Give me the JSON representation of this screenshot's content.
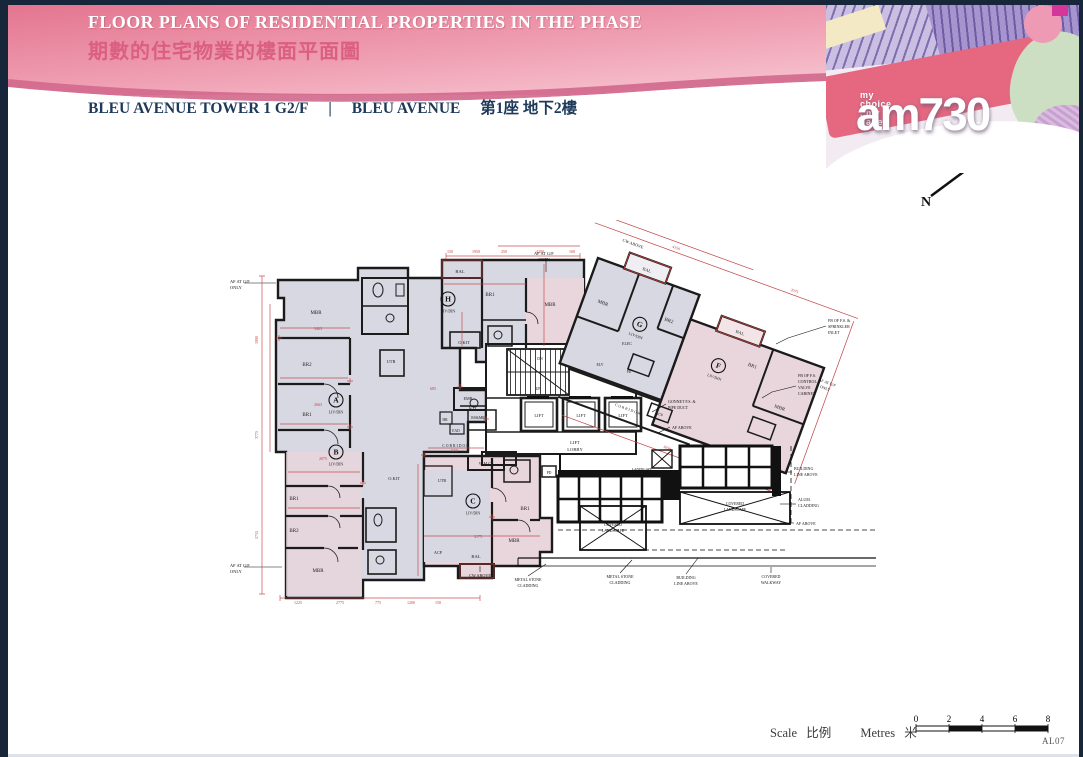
{
  "banner": {
    "title_en": "FLOOR PLANS OF RESIDENTIAL PROPERTIES IN THE PHASE",
    "title_zh": "期數的住宅物業的樓面平面圖"
  },
  "masthead": {
    "tagline": "my choice . my paper",
    "brand": "am730"
  },
  "subtitle": {
    "tower": "BLEU AVENUE TOWER 1  G2/F",
    "divider": "|",
    "name_en": "BLEU AVENUE",
    "name_zh": "第1座 地下2樓"
  },
  "compass": {
    "label": "N"
  },
  "scale_bar": {
    "label_en": "Scale",
    "label_zh": "比例",
    "unit_en": "Metres",
    "unit_zh": "米",
    "ticks": [
      "0",
      "2",
      "4",
      "6",
      "8"
    ]
  },
  "footer": {
    "page_code": "AL07"
  },
  "plan": {
    "colors": {
      "wall": "#1b1b1b",
      "dim": "#c24040",
      "text": "#222222",
      "annot": "#111111",
      "fill_gray": "#d8d8e2",
      "fill_pink": "#e9d6dc"
    },
    "unit_badges": [
      {
        "letter": "A",
        "sub": "LIV/DIN",
        "x": 108,
        "y": 180
      },
      {
        "letter": "B",
        "sub": "LIV/DIN",
        "x": 108,
        "y": 232
      },
      {
        "letter": "C",
        "sub": "LIV/DIN",
        "x": 245,
        "y": 281
      },
      {
        "letter": "H",
        "sub": "LIV/DIN",
        "x": 220,
        "y": 79
      }
    ],
    "rot_unit_badges": [
      {
        "letter": "G",
        "sub": "LIV/DIN",
        "x": 62,
        "y": 48
      },
      {
        "letter": "F",
        "sub": "LIV/DIN",
        "x": 150,
        "y": 60
      }
    ],
    "labels": [
      {
        "t": "MBR",
        "x": 88,
        "y": 94
      },
      {
        "t": "BR2",
        "x": 79,
        "y": 146
      },
      {
        "t": "BR1",
        "x": 79,
        "y": 196
      },
      {
        "t": "UTR",
        "x": 163,
        "y": 143,
        "s": 4.4
      },
      {
        "t": "KIT",
        "x": 245,
        "y": 190,
        "s": 4.8
      },
      {
        "t": "BR1",
        "x": 66,
        "y": 280
      },
      {
        "t": "BR2",
        "x": 66,
        "y": 312
      },
      {
        "t": "MBR",
        "x": 90,
        "y": 352
      },
      {
        "t": "W.M.C",
        "x": 257,
        "y": 245,
        "s": 4.2
      },
      {
        "t": "UTR",
        "x": 214,
        "y": 262,
        "s": 4.2
      },
      {
        "t": "O.KIT",
        "x": 166,
        "y": 260,
        "s": 4.4
      },
      {
        "t": "BR1",
        "x": 297,
        "y": 290
      },
      {
        "t": "MBR",
        "x": 286,
        "y": 322
      },
      {
        "t": "BAL",
        "x": 248,
        "y": 338,
        "s": 4.6
      },
      {
        "t": "ACP",
        "x": 210,
        "y": 334,
        "s": 4.2
      },
      {
        "t": "CW ABOVE",
        "x": 252,
        "y": 357,
        "s": 4.2,
        "c": "#111111"
      },
      {
        "t": "BAL",
        "x": 232,
        "y": 53,
        "s": 4.6
      },
      {
        "t": "BR1",
        "x": 262,
        "y": 76
      },
      {
        "t": "MBR",
        "x": 322,
        "y": 86
      },
      {
        "t": "O.KIT",
        "x": 236,
        "y": 124,
        "s": 4.4
      },
      {
        "t": "EMR",
        "x": 240,
        "y": 180,
        "s": 4.2
      },
      {
        "t": "HR",
        "x": 217,
        "y": 201,
        "s": 3.8
      },
      {
        "t": "RS&MR",
        "x": 250,
        "y": 199,
        "s": 3.8
      },
      {
        "t": "EAD",
        "x": 228,
        "y": 212,
        "s": 3.6
      },
      {
        "t": "DN",
        "x": 312,
        "y": 140,
        "s": 3.8
      },
      {
        "t": "UP",
        "x": 310,
        "y": 170,
        "s": 3.8
      },
      {
        "t": "LIFT",
        "x": 311,
        "y": 197,
        "s": 4.4
      },
      {
        "t": "LIFT",
        "x": 353,
        "y": 197,
        "s": 4.4
      },
      {
        "t": "LIFT",
        "x": 395,
        "y": 197,
        "s": 4.4
      },
      {
        "t": "LIFT",
        "x": 347,
        "y": 224,
        "s": 4.6
      },
      {
        "t": "LOBBY",
        "x": 347,
        "y": 231,
        "s": 4.6
      },
      {
        "t": "CORRIDOR",
        "x": 228,
        "y": 227,
        "s": 3.8,
        "ls": 1
      },
      {
        "t": "PD",
        "x": 321,
        "y": 254,
        "s": 3.8
      },
      {
        "t": "ELEC",
        "x": 399,
        "y": 125,
        "s": 4
      },
      {
        "t": "ELV",
        "x": 372,
        "y": 146,
        "s": 3.8
      },
      {
        "t": "PD",
        "x": 401,
        "y": 153,
        "s": 3.6
      },
      {
        "t": "AF AT G/F",
        "x": 2,
        "y": 63,
        "a": "start",
        "s": 4.4,
        "c": "#111111"
      },
      {
        "t": "ONLY",
        "x": 2,
        "y": 69,
        "a": "start",
        "s": 4.4,
        "c": "#111111"
      },
      {
        "t": "AF AT G/F",
        "x": 2,
        "y": 347,
        "a": "start",
        "s": 4.4,
        "c": "#111111"
      },
      {
        "t": "ONLY",
        "x": 2,
        "y": 353,
        "a": "start",
        "s": 4.4,
        "c": "#111111"
      },
      {
        "t": "AF AT G/F",
        "x": 306,
        "y": 35,
        "a": "start",
        "s": 4.4,
        "c": "#111111"
      },
      {
        "t": "ONLY",
        "x": 310,
        "y": 41,
        "a": "start",
        "s": 4.4,
        "c": "#111111"
      },
      {
        "t": "GONNET F.S. &",
        "x": 440,
        "y": 183,
        "a": "start",
        "s": 4,
        "c": "#111111"
      },
      {
        "t": "PIPE DUCT",
        "x": 440,
        "y": 189,
        "a": "start",
        "s": 4,
        "c": "#111111"
      },
      {
        "t": "AF ABOVE",
        "x": 444,
        "y": 209,
        "a": "start",
        "s": 4,
        "c": "#111111"
      },
      {
        "t": "FB OF F.S.",
        "x": 570,
        "y": 157,
        "a": "start",
        "s": 4,
        "c": "#111111"
      },
      {
        "t": "CONTROL",
        "x": 570,
        "y": 163,
        "a": "start",
        "s": 4,
        "c": "#111111"
      },
      {
        "t": "VALVE",
        "x": 570,
        "y": 169,
        "a": "start",
        "s": 4,
        "c": "#111111"
      },
      {
        "t": "CABINET",
        "x": 570,
        "y": 175,
        "a": "start",
        "s": 4,
        "c": "#111111"
      },
      {
        "t": "FB OF F.S. &",
        "x": 600,
        "y": 102,
        "a": "start",
        "s": 4,
        "c": "#111111"
      },
      {
        "t": "SPRINKLER",
        "x": 600,
        "y": 108,
        "a": "start",
        "s": 4,
        "c": "#111111"
      },
      {
        "t": "INLET",
        "x": 600,
        "y": 114,
        "a": "start",
        "s": 4,
        "c": "#111111"
      },
      {
        "t": "BUILDING",
        "x": 566,
        "y": 250,
        "a": "start",
        "s": 4,
        "c": "#111111"
      },
      {
        "t": "LINE ABOVE",
        "x": 566,
        "y": 256,
        "a": "start",
        "s": 4,
        "c": "#111111"
      },
      {
        "t": "ALUM.",
        "x": 570,
        "y": 281,
        "a": "start",
        "s": 4,
        "c": "#111111"
      },
      {
        "t": "CLADDING",
        "x": 570,
        "y": 287,
        "a": "start",
        "s": 4,
        "c": "#111111"
      },
      {
        "t": "AF ABOVE",
        "x": 568,
        "y": 305,
        "a": "start",
        "s": 4,
        "c": "#111111"
      },
      {
        "t": "METAL STONE",
        "x": 300,
        "y": 361,
        "s": 4,
        "c": "#111111"
      },
      {
        "t": "CLADDING",
        "x": 300,
        "y": 367,
        "s": 4,
        "c": "#111111"
      },
      {
        "t": "METAL STONE",
        "x": 392,
        "y": 358,
        "s": 4,
        "c": "#111111"
      },
      {
        "t": "CLADDING",
        "x": 392,
        "y": 364,
        "s": 4,
        "c": "#111111"
      },
      {
        "t": "BUILDING",
        "x": 458,
        "y": 359,
        "s": 4,
        "c": "#111111"
      },
      {
        "t": "LINE ABOVE",
        "x": 458,
        "y": 365,
        "s": 4,
        "c": "#111111"
      },
      {
        "t": "COVERED",
        "x": 543,
        "y": 358,
        "s": 4,
        "c": "#111111"
      },
      {
        "t": "WALKWAY",
        "x": 543,
        "y": 364,
        "s": 4,
        "c": "#111111"
      },
      {
        "t": "COVERED",
        "x": 385,
        "y": 306,
        "s": 3.8,
        "c": "#111111"
      },
      {
        "t": "LANDSCAPE",
        "x": 385,
        "y": 312,
        "s": 3.8,
        "c": "#111111"
      },
      {
        "t": "COVERED",
        "x": 507,
        "y": 285,
        "s": 3.8,
        "c": "#111111"
      },
      {
        "t": "LANDSCAPE",
        "x": 507,
        "y": 291,
        "s": 3.8,
        "c": "#111111"
      },
      {
        "t": "LANDSCAPE",
        "x": 414,
        "y": 250,
        "s": 3.4,
        "c": "#111111"
      },
      {
        "t": "VOID",
        "x": 414,
        "y": 256,
        "s": 3.4,
        "c": "#111111"
      }
    ],
    "rot_labels": [
      {
        "t": "MBR",
        "x": 20,
        "y": 42
      },
      {
        "t": "BAL",
        "x": 50,
        "y": -4,
        "s": 4.4
      },
      {
        "t": "BR2",
        "x": 88,
        "y": 36
      },
      {
        "t": "BAL",
        "x": 159,
        "y": 23,
        "s": 4.4
      },
      {
        "t": "BR1",
        "x": 182,
        "y": 50
      },
      {
        "t": "MBR",
        "x": 222,
        "y": 80
      },
      {
        "t": "ACP",
        "x": 111,
        "y": 127,
        "s": 4
      },
      {
        "t": "ACP",
        "x": 216,
        "y": 137,
        "s": 4
      },
      {
        "t": "CW ABOVE",
        "x": 28,
        "y": -24,
        "s": 4.2,
        "c": "#111111"
      },
      {
        "t": "AF AT G/F",
        "x": 258,
        "y": 40,
        "s": 4,
        "c": "#111111"
      },
      {
        "t": "ONLY",
        "x": 258,
        "y": 46,
        "s": 4,
        "c": "#111111"
      },
      {
        "t": "CORRIDOR",
        "x": 80,
        "y": 133,
        "s": 3.8,
        "ls": 1
      }
    ],
    "dims": [
      {
        "t": "1225",
        "x": 70,
        "y": 384
      },
      {
        "t": "2775",
        "x": 112,
        "y": 384
      },
      {
        "t": "775",
        "x": 150,
        "y": 384
      },
      {
        "t": "1200",
        "x": 183,
        "y": 384
      },
      {
        "t": "150",
        "x": 210,
        "y": 384
      },
      {
        "t": "150",
        "x": 222,
        "y": 33
      },
      {
        "t": "1950",
        "x": 248,
        "y": 33
      },
      {
        "t": "250",
        "x": 276,
        "y": 33
      },
      {
        "t": "4200",
        "x": 312,
        "y": 33
      },
      {
        "t": "100",
        "x": 344,
        "y": 33
      },
      {
        "t": "1990",
        "x": 30,
        "y": 120,
        "r": -90
      },
      {
        "t": "3775",
        "x": 30,
        "y": 215,
        "r": -90
      },
      {
        "t": "5715",
        "x": 30,
        "y": 315,
        "r": -90
      },
      {
        "t": "3463",
        "x": 90,
        "y": 110
      },
      {
        "t": "2663",
        "x": 90,
        "y": 186
      },
      {
        "t": "2075",
        "x": 95,
        "y": 240
      },
      {
        "t": "685",
        "x": 205,
        "y": 170
      },
      {
        "t": "1150",
        "x": 226,
        "y": 232
      },
      {
        "t": "3175",
        "x": 250,
        "y": 318
      }
    ],
    "rot_dims": [
      {
        "t": "4150",
        "x": 70,
        "y": -35
      },
      {
        "t": "2075",
        "x": 196,
        "y": -35
      },
      {
        "t": "3050",
        "x": 130,
        "y": 156
      }
    ]
  }
}
